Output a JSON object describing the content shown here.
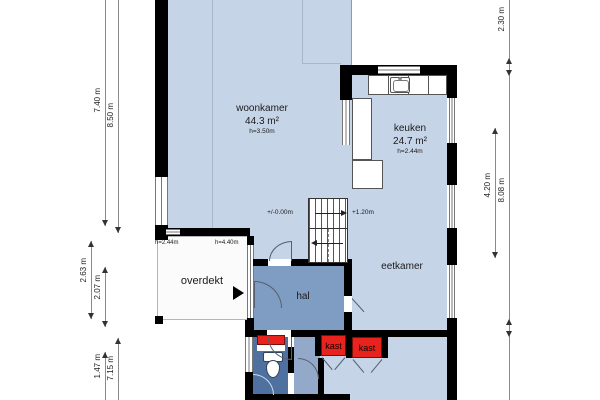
{
  "rooms": {
    "woonkamer": {
      "name": "woonkamer",
      "area": "44.3 m²",
      "ceiling": "h=3.50m"
    },
    "keuken": {
      "name": "keuken",
      "area": "24.7 m²",
      "ceiling": "h=2.44m"
    },
    "eetkamer": {
      "name": "eetkamer"
    },
    "hal": {
      "name": "hal"
    },
    "overdekt": {
      "name": "overdekt"
    },
    "kast_left": {
      "name": "kast"
    },
    "kast_right": {
      "name": "kast"
    }
  },
  "annotations": {
    "floor_level": "+/-0.00m",
    "stair_landing": "+1.20m",
    "height_left": "h=2.44m",
    "height_right": "h=4.40m"
  },
  "dims": {
    "left1": "7.40 m",
    "left2": "8.50 m",
    "left3": "2.63 m",
    "left4": "2.07 m",
    "left5": "1.47 m",
    "left6": "7.15 m",
    "right1": "4.20 m",
    "right2": "2.30 m",
    "right3": "8.08 m"
  },
  "colors": {
    "room_fill": "#c6d4e8",
    "hal_fill": "#7f9dc2",
    "toilet_fill": "#4f719f",
    "corridor_fill": "#93a9c9",
    "kast_fill": "#e8231d",
    "overdekt_fill": "#fbfbfb",
    "wall": "#000000"
  }
}
